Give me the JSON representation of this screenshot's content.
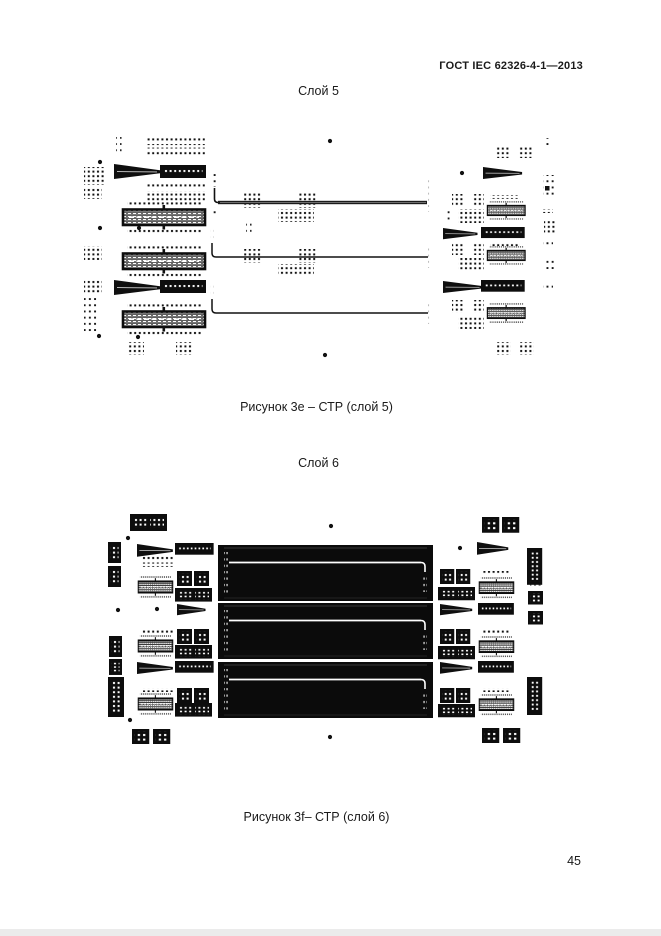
{
  "document": {
    "header": "ГОСТ IEC 62326-4-1—2013",
    "page_number": "45",
    "figures": [
      {
        "layer_label": "Слой 5",
        "caption": "Рисунок 3e – СТР (слой 5)"
      },
      {
        "layer_label": "Слой 6",
        "caption": "Рисунок 3f– СТР (слой 6)"
      }
    ]
  }
}
